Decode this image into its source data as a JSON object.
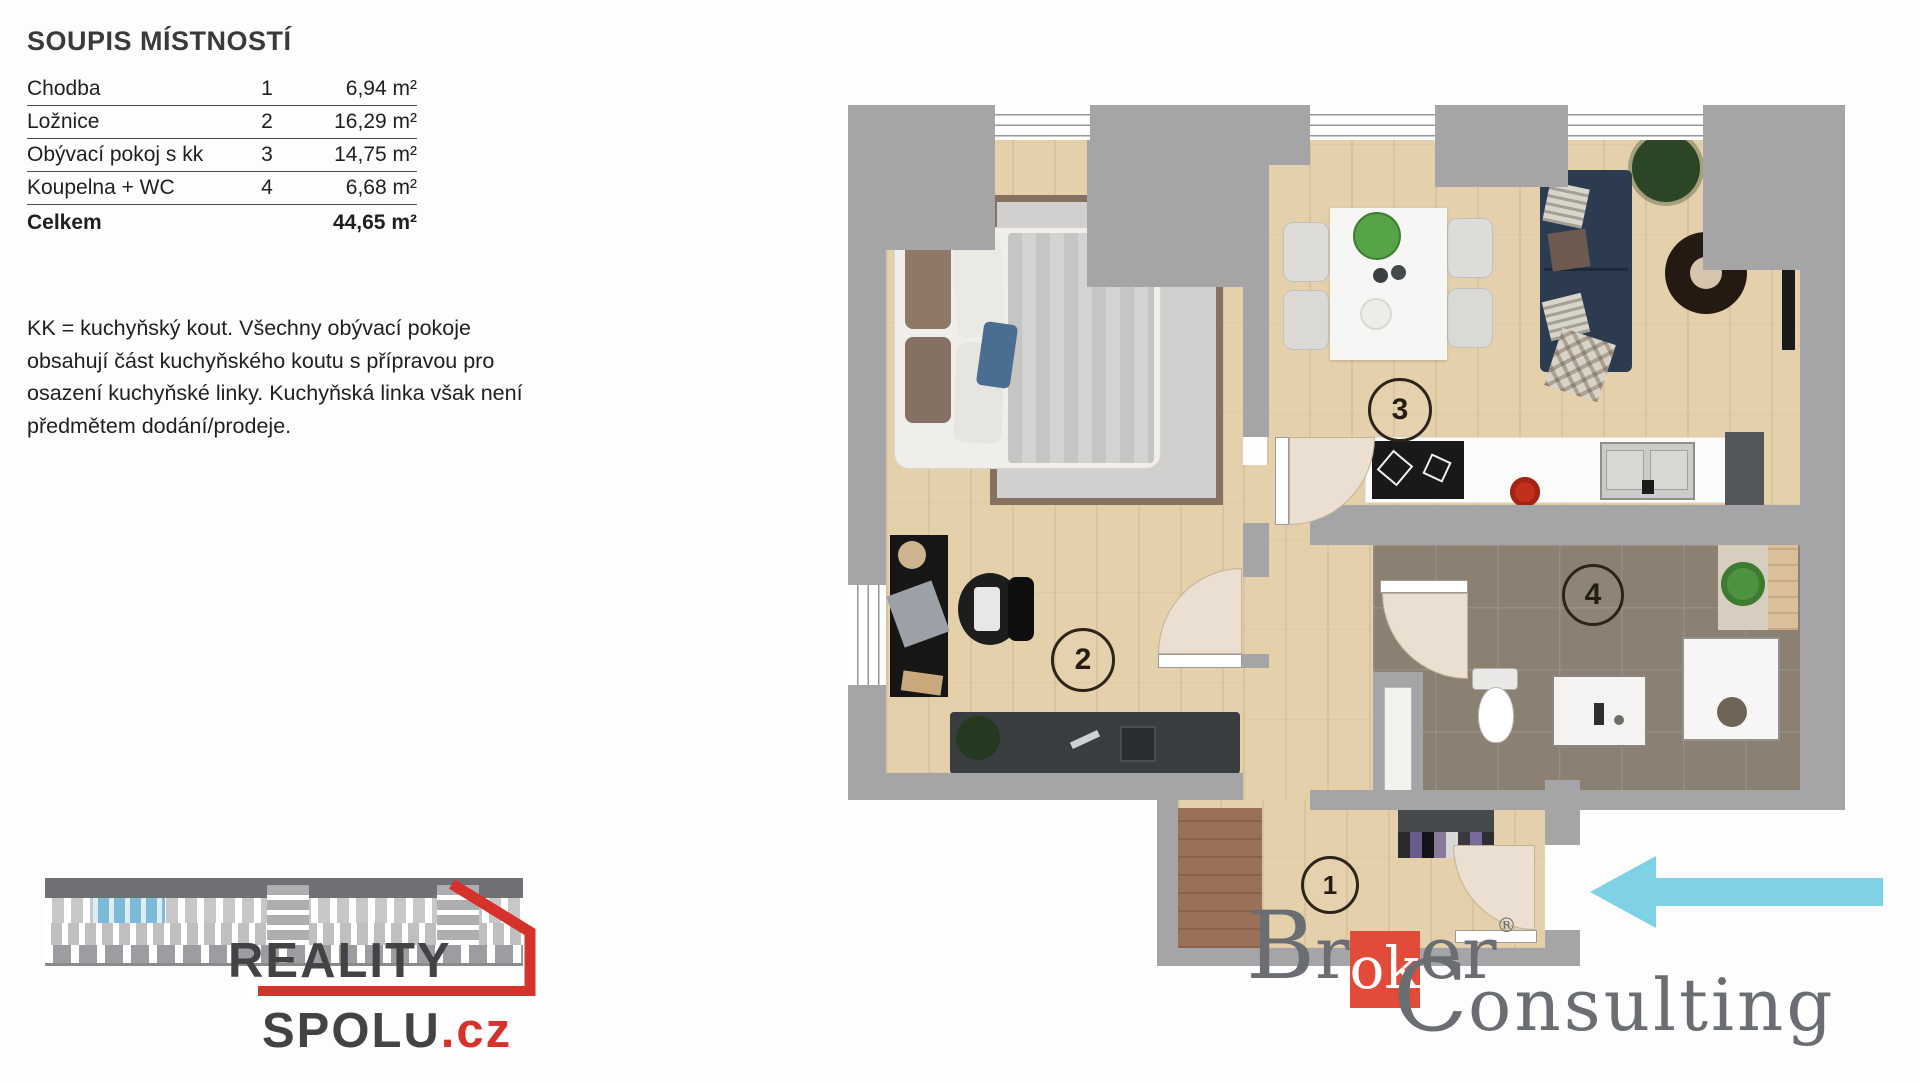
{
  "room_list": {
    "title": "SOUPIS MÍSTNOSTÍ",
    "rows": [
      {
        "name": "Chodba",
        "number": "1",
        "area": "6,94 m²"
      },
      {
        "name": "Ložnice",
        "number": "2",
        "area": "16,29 m²"
      },
      {
        "name": "Obývací pokoj s kk",
        "number": "3",
        "area": "14,75 m²"
      },
      {
        "name": "Koupelna + WC",
        "number": "4",
        "area": "6,68 m²"
      }
    ],
    "total": {
      "label": "Celkem",
      "area": "44,65 m²"
    }
  },
  "note": {
    "line1": "KK = kuchyňský kout. Všechny obývací pokoje",
    "line2": "obsahují část kuchyňského koutu s přípravou pro",
    "line3": "osazení kuchyňské linky. Kuchyňská linka však není",
    "line4": "předmětem dodání/prodeje."
  },
  "floorplan": {
    "room_labels": {
      "hallway": "1",
      "bedroom": "2",
      "living": "3",
      "bathroom": "4"
    },
    "entry_arrow_direction": "left",
    "colors": {
      "wall": "#a5a5a7",
      "wood_floor": "#e5d0ac",
      "bath_floor": "#8b8072",
      "arrow": "#7fd2e6"
    }
  },
  "branding": {
    "reality_spolu": {
      "word1": "REALITY",
      "word2": "SPOLU",
      "tld": ".cz",
      "accent": "#d5322c",
      "text_color": "#434346"
    },
    "broker_consulting": {
      "b": "B",
      "r": "r",
      "ok": "ok",
      "er": "er",
      "reg": "®",
      "c": "C",
      "onsulting": "onsulting",
      "accent": "#e24a3a",
      "text_color": "#6a6e72"
    }
  }
}
